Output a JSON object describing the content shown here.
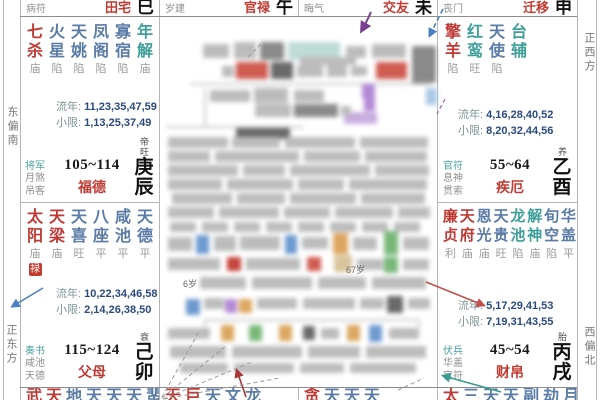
{
  "chart": {
    "kind": "ziwei-doushu-natal-chart",
    "center_note": "redacted-personal-info"
  },
  "colors": {
    "accent_red": "#c03b33",
    "minor_star_blue": "#5a7ca6",
    "minor_star_teal": "#3f9f9a",
    "status_gray": "#9b9b9b",
    "shensha_teal": "#4ba3a3",
    "numbers_navy": "#2b4a7d"
  },
  "sides": {
    "left_top": "东偏南",
    "left_bottom": "正东方",
    "right_top": "正西方",
    "right_bottom": "西偏北"
  },
  "top_row": [
    {
      "shensha": "病符",
      "palace": "田宅",
      "branch": "巳"
    },
    {
      "shensha": "岁建",
      "palace": "官禄",
      "branch": "午"
    },
    {
      "shensha": "晦气",
      "palace": "交友",
      "branch": "未"
    },
    {
      "shensha": "丧门",
      "palace": "迁移",
      "branch": "申"
    }
  ],
  "palaces": {
    "chen": {
      "stars": [
        {
          "chars": "七杀",
          "status": "庙",
          "color": "red"
        },
        {
          "chars": "火星",
          "status": "陷",
          "color": "blue"
        },
        {
          "chars": "天姚",
          "status": "陷",
          "color": "blue"
        },
        {
          "chars": "凤阁",
          "status": "陷",
          "color": "blue"
        },
        {
          "chars": "寡宿",
          "status": "陷",
          "color": "blue"
        },
        {
          "chars": "年解",
          "status": "庙",
          "color": "teal"
        }
      ],
      "liunian": {
        "label": "流年:",
        "nums": "11,23,35,47,59"
      },
      "xiaoxian": {
        "label": "小限:",
        "nums": "1,13,25,37,49"
      },
      "shensha": [
        "将军",
        "月煞",
        "吊客"
      ],
      "age_range": "105~114",
      "palace_name": "福德",
      "stage": "帝旺",
      "stem": "庚",
      "branch": "辰"
    },
    "you": {
      "stars": [
        {
          "chars": "擎羊",
          "status": "陷",
          "color": "red"
        },
        {
          "chars": "红鸾",
          "status": "旺",
          "color": "teal"
        },
        {
          "chars": "天使",
          "status": "陷",
          "color": "blue"
        },
        {
          "chars": "台辅",
          "status": "",
          "color": "teal"
        }
      ],
      "liunian": {
        "label": "流年:",
        "nums": "4,16,28,40,52"
      },
      "xiaoxian": {
        "label": "小限:",
        "nums": "8,20,32,44,56"
      },
      "shensha": [
        "官符",
        "息神",
        "贯索"
      ],
      "age_range": "55~64",
      "palace_name": "疾厄",
      "stage": "养",
      "stem": "乙",
      "branch": "酉"
    },
    "mao": {
      "stars": [
        {
          "chars": "太阳",
          "status": "庙",
          "color": "red",
          "badge": "禄"
        },
        {
          "chars": "天梁",
          "status": "庙",
          "color": "red"
        },
        {
          "chars": "天喜",
          "status": "旺",
          "color": "blue"
        },
        {
          "chars": "八座",
          "status": "平",
          "color": "blue"
        },
        {
          "chars": "咸池",
          "status": "平",
          "color": "blue"
        },
        {
          "chars": "天德",
          "status": "平",
          "color": "blue"
        }
      ],
      "liunian": {
        "label": "流年:",
        "nums": "10,22,34,46,58"
      },
      "xiaoxian": {
        "label": "小限:",
        "nums": "2,14,26,38,50"
      },
      "shensha": [
        "奏书",
        "咸池",
        "天德"
      ],
      "age_range": "115~124",
      "palace_name": "父母",
      "stage": "衰",
      "stem": "己",
      "branch": "卯"
    },
    "xu": {
      "stars": [
        {
          "chars": "廉贞",
          "status": "利",
          "color": "red"
        },
        {
          "chars": "天府",
          "status": "庙",
          "color": "red"
        },
        {
          "chars": "恩光",
          "status": "庙",
          "color": "blue"
        },
        {
          "chars": "天贵",
          "status": "旺",
          "color": "blue"
        },
        {
          "chars": "龙池",
          "status": "陷",
          "color": "teal"
        },
        {
          "chars": "解神",
          "status": "庙",
          "color": "teal"
        },
        {
          "chars": "旬空",
          "status": "陷",
          "color": "blue"
        },
        {
          "chars": "华盖",
          "status": "平",
          "color": "blue"
        }
      ],
      "liunian": {
        "label": "流年:",
        "nums": "5,17,29,41,53"
      },
      "xiaoxian": {
        "label": "小限:",
        "nums": "7,19,31,43,55"
      },
      "shensha": [
        "伏兵",
        "华盖",
        "官符"
      ],
      "age_range": "45~54",
      "palace_name": "财帛",
      "stage": "胎",
      "stem": "丙",
      "branch": "戌"
    }
  },
  "bottom_row": [
    {
      "chars": [
        {
          "t": "武",
          "color": "red"
        },
        {
          "t": "天",
          "color": "red"
        },
        {
          "t": "地",
          "color": "blue"
        },
        {
          "t": "天",
          "color": "blue"
        },
        {
          "t": "天",
          "color": "blue"
        },
        {
          "t": "天",
          "color": "blue"
        },
        {
          "t": "蜚",
          "color": "blue"
        }
      ]
    },
    {
      "chars": [
        {
          "t": "天",
          "color": "red"
        },
        {
          "t": "巨",
          "color": "red"
        },
        {
          "t": "天",
          "color": "blue"
        },
        {
          "t": "文",
          "color": "blue"
        },
        {
          "t": "龙",
          "color": "blue"
        }
      ]
    },
    {
      "chars": [
        {
          "t": "贪",
          "color": "red"
        },
        {
          "t": "天",
          "color": "blue"
        },
        {
          "t": "天",
          "color": "blue"
        },
        {
          "t": "天",
          "color": "blue"
        }
      ]
    },
    {
      "chars": [
        {
          "t": "太",
          "color": "red"
        },
        {
          "t": "三",
          "color": "blue"
        },
        {
          "t": "天",
          "color": "blue"
        },
        {
          "t": "天",
          "color": "blue"
        },
        {
          "t": "副",
          "color": "blue"
        },
        {
          "t": "劫",
          "color": "blue"
        },
        {
          "t": "月",
          "color": "blue"
        }
      ]
    }
  ],
  "center": {
    "age_small": "6岁",
    "age_mid": "67岁"
  }
}
